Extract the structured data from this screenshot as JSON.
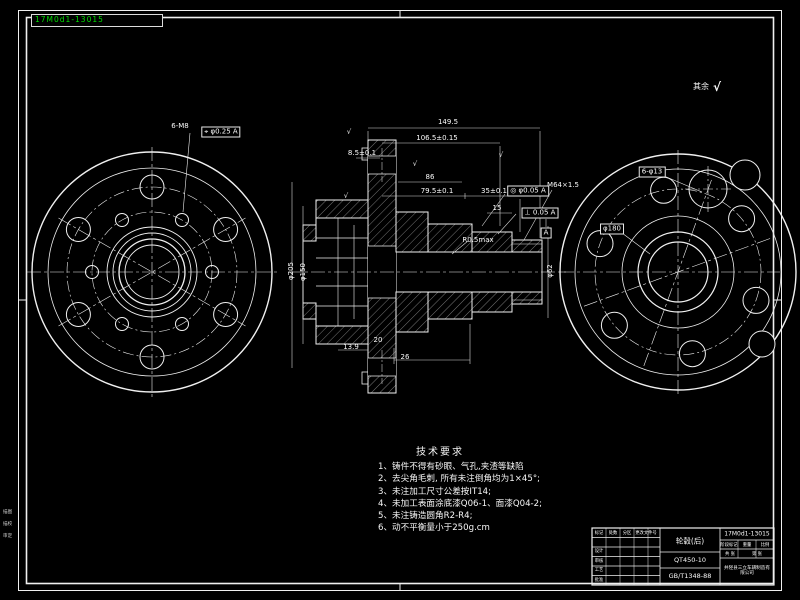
{
  "sheet": {
    "green_label": "17M0d1-13015",
    "margin_notes": [
      "描图",
      "描校",
      "审定"
    ]
  },
  "tech_requirements": {
    "title": "技术要求",
    "items": [
      "1、铸件不得有砂眼、气孔,夹渣等缺陷",
      "2、去尖角毛刺, 所有未注倒角均为1×45°;",
      "3、未注加工尺寸公差按IT14;",
      "4、未加工表面涂底漆Q06-1、面漆Q04-2;",
      "5、未注铸造圆角R2-R4;",
      "6、动不平衡量小于250g.cm"
    ]
  },
  "title_block": {
    "part_name": "轮毂(后)",
    "material": "QT450-10",
    "standard": "GB/T1348-88",
    "drawing_no": "17M0d1-13015",
    "company": "井陉县三立车辆制造有限公司",
    "fields": {
      "mark": "标记",
      "count": "处数",
      "zone": "分区",
      "doc": "更改文件号",
      "design": "设计",
      "audit": "审核",
      "craft": "工艺",
      "approve": "批准",
      "stage": "阶段标记",
      "weight": "重量",
      "scale": "比例",
      "total": "共 张",
      "page": "第 张"
    }
  },
  "dimensions": [
    "149.5",
    "106.5±0.15",
    "8.5±0.1",
    "86",
    "79.5±0.1",
    "35±0.1",
    "15",
    "R0.5max",
    "M64×1.5",
    "◎ φ0.05 A",
    "⊥ 0.05 A",
    "6-M8",
    "⌖ φ0.25 A",
    "6-φ13",
    "φ180",
    "13.9",
    "26",
    "20",
    "φ205",
    "φ150",
    "φ62",
    "其余",
    "√",
    "√",
    "√",
    "√",
    "A",
    "√"
  ]
}
